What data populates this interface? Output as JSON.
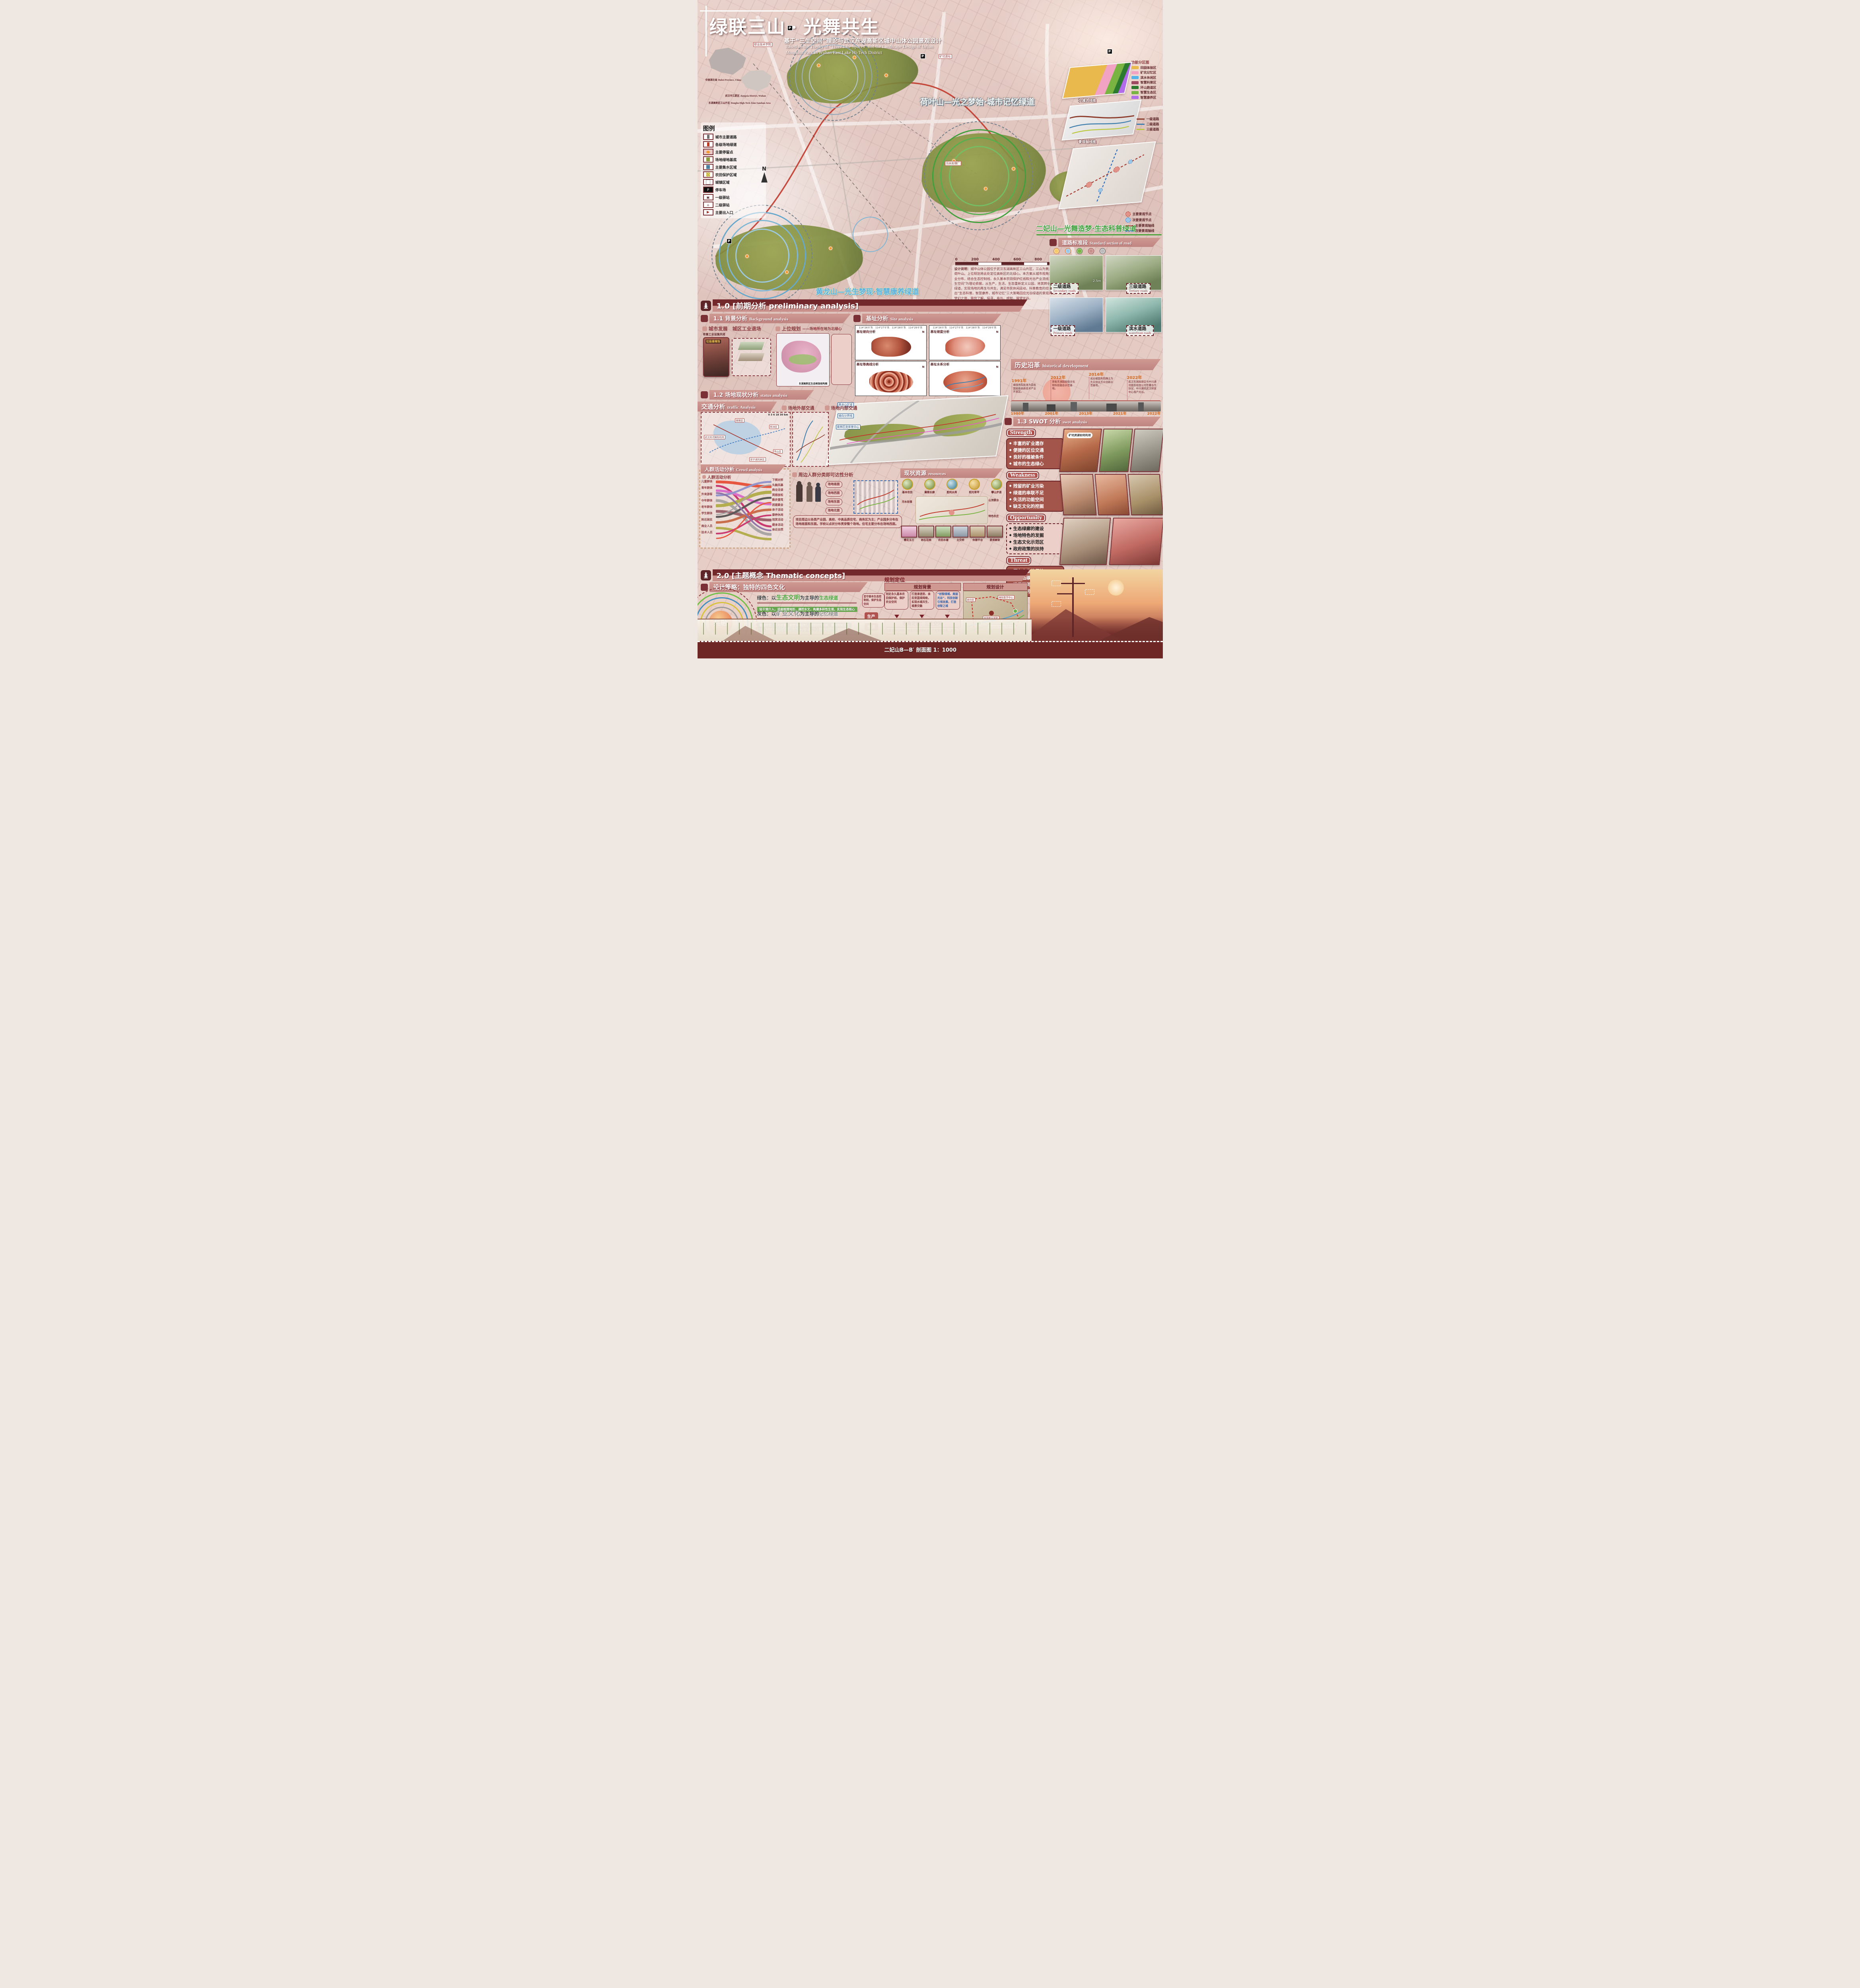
{
  "poster": {
    "title": "绿联三山 · 光舞共生",
    "subtitle_zh": "基于“三生空间”理论与武汉东湖高新区城中山体公园景观设计",
    "subtitle_en1": "Based on the Theory of \"Three Life Spaces\" and the Landscape Design of Urban",
    "subtitle_en2": "Mountain Park in Wuhan East Lake Hi-Tech District"
  },
  "location_maps": [
    {
      "zh": "中国湖北省",
      "en": "Hubei Province, China"
    },
    {
      "zh": "武汉市江夏区",
      "en": "Jiangxia District, Wuhan"
    },
    {
      "zh": "东湖高新区三山片区",
      "en": "Donghu High-Tech Zone Sanshan Area"
    }
  ],
  "legend": {
    "title": "图例",
    "items": [
      {
        "label": "城市主要道路"
      },
      {
        "label": "各级场地绿道"
      },
      {
        "label": "主要停留点"
      },
      {
        "label": "场地绿地基底"
      },
      {
        "label": "主要集水区域"
      },
      {
        "label": "农田保护区域"
      },
      {
        "label": "城镇区域"
      },
      {
        "label": "停车场"
      },
      {
        "label": "一级驿站"
      },
      {
        "label": "二级驿站"
      },
      {
        "label": "主要出入口"
      }
    ]
  },
  "main_map": {
    "north": "N",
    "scalebar": [
      "0",
      "200",
      "400",
      "600",
      "800",
      "1000 M"
    ],
    "banners": [
      {
        "text": "荷叶山—光之梦始·城市记忆绿道"
      },
      {
        "text": "二妃山—光舞造梦·生态科普绿道"
      },
      {
        "text": "黄龙山—光生梦现·智慧康养绿道"
      }
    ],
    "labels": [
      "职业技术学院",
      "矿坑遗址",
      "污水处理厂"
    ],
    "parking": "P"
  },
  "side_maps": {
    "functional": {
      "title": "功能分区图",
      "legend": [
        {
          "label": "田园体验区",
          "color": "#eab94d"
        },
        {
          "label": "矿坑记忆区",
          "color": "#f2a3c3"
        },
        {
          "label": "滨水休闲区",
          "color": "#54b4ea"
        },
        {
          "label": "智慧科普区",
          "color": "#9e4a62"
        },
        {
          "label": "环山跑道区",
          "color": "#2c7a2e"
        },
        {
          "label": "智慧生态区",
          "color": "#79b342"
        },
        {
          "label": "智慧康养区",
          "color": "#b26ce9"
        }
      ]
    },
    "traffic": {
      "title": "交通流线图",
      "legend": [
        {
          "label": "一级道路",
          "color": "#8c3a2a"
        },
        {
          "label": "二级道路",
          "color": "#3f7fae"
        },
        {
          "label": "三级道路",
          "color": "#bcc940"
        }
      ]
    },
    "axis": {
      "title": "景观轴线图",
      "legend": [
        {
          "label": "主要景观节点",
          "color": "#e2938a"
        },
        {
          "label": "次要景观节点",
          "color": "#9cc8e8"
        },
        {
          "label": "主要景观轴线",
          "color": "#a33226"
        },
        {
          "label": "次要景观轴线",
          "color": "#2f6fbf"
        }
      ]
    }
  },
  "design_note": {
    "label": "设计说明：",
    "text": "城中山体公园位于武汉东湖高新区三山片区，三山为黄龙山、二妃山和荷叶山。上位规划将此处定位高新区的北绿心。本方案从城市视角宏观分析片区产业分布，结合生态控制线，永久基本农田保护红线和光谷产业流线为依托，以“三生空间”为理论依据，从生产，生活，生态重新定义公园，将其转化为连接城市的绿道，实现场地的再生与共生，满足市民休闲运动，科普教育的综合性绿道。提出“生态科普，智慧康养，城市记忆”三大策略回应光谷绿道的景观问题，打造光谷梦幻之旅，带您了解，探寻，参与，感知，展望光谷。"
  },
  "road_section": {
    "title_zh": "道路标准段",
    "title_en": "Standard section of road",
    "dim": "2.5m",
    "roads": [
      {
        "zh": "二级道路",
        "en": "Secondary roads"
      },
      {
        "zh": "三级道路",
        "en": "Tertiary roads"
      },
      {
        "zh": "一级道路",
        "en": "Primary roads"
      },
      {
        "zh": "滨水道路",
        "en": "waterfront roads"
      }
    ]
  },
  "s10": {
    "label": "1.0 [前期分析 preliminary analysis]"
  },
  "s11": {
    "label_zh": "1.1 背景分析",
    "label_en": "Background analysis",
    "city_head": "城市发展　城区工业退场",
    "city_note": "有害工业设施关闭",
    "city_caption": "垃圾填埋场",
    "upper_head": "上位规划",
    "upper_dash": "——场地所在地为北绿心",
    "upper_caption": "东湖高新区生态框架结构图"
  },
  "s12": {
    "label_zh": "1.2 场地现状分析",
    "label_en": "status analysis"
  },
  "traffic_analysis": {
    "label_zh": "交通分析",
    "label_en": "traffic Analysis",
    "sub1": "场地外部交通",
    "sub2": "场地内部交通",
    "ext_labels": [
      "武汉天河国际机场",
      "黄陂区",
      "新洲区",
      "梁子湖风景区",
      "铁山区"
    ],
    "scalebar": "0 3 6 18 30 km"
  },
  "site_analysis": {
    "label_zh": "基址分析",
    "label_en": "Site analysis",
    "north": "N",
    "coords": "114°26′0″东　114°27′0″东　114°28′0″东　114°29′0″东",
    "panels": [
      "基址坡向分析",
      "基址坡度分析",
      "基址等高线分析",
      "基址水系分析"
    ],
    "axon_labels": [
      "黄龙山区域",
      "坡向分界线",
      "奥林匹克体育中心"
    ]
  },
  "history": {
    "label_zh": "历史沿革",
    "label_en": "historical development",
    "top": [
      {
        "year": "1991年",
        "text": "被国务院批准为首批国家级高新技术产业开发区。"
      },
      {
        "year": "2012年",
        "text": "获批东湖国家级文化和科技融合示范基地。"
      },
      {
        "year": "2016年",
        "text": "光谷被国务院确立为大众创业万众创新示范基地。"
      },
      {
        "year": "2022年",
        "text": "武汉东湖高新区与中兴通讯股份有限公司签署合作协议，中兴通讯武汉研发中心落户光谷。"
      }
    ],
    "bottom_years": [
      "1980年",
      "2001年",
      "2013年",
      "2021年",
      "2022年"
    ]
  },
  "swot": {
    "label_zh": "1.3 SWOT 分析",
    "label_en": "swot analysis",
    "bubble": "矿坑资源如何利用",
    "s": {
      "title": "Strength",
      "items": [
        "丰富的矿业遗存",
        "便捷的区位交通",
        "良好的植被条件",
        "城市的生态绿心"
      ]
    },
    "w": {
      "title": "Weakness",
      "items": [
        "残留的矿业污染",
        "绿道的串联不足",
        "失活的功能空间",
        "缺乏文化的挖掘"
      ]
    },
    "o": {
      "title": "Opportunity",
      "items": [
        "生态绿廊的建设",
        "场地特色的发掘",
        "生态文化示范区",
        "政府政策的扶持"
      ]
    },
    "t": {
      "title": "Threat",
      "items": [
        "原有产业的保护",
        "绿色低碳的要求",
        "满足不同的需求",
        "发展的可持续性"
      ]
    }
  },
  "crowd": {
    "label_zh": "人群活动分析",
    "label_en": "Crowd analysis",
    "sub": "人群活动分析",
    "groups": [
      "儿童群体",
      "青年群体",
      "外来游客",
      "中年群体",
      "老年群体",
      "学生群体",
      "附近居民",
      "商业人员",
      "技术人员"
    ],
    "activities": [
      "下棋对弈",
      "头脑风暴",
      "商业洽谈",
      "冥想放松",
      "散步遛弯",
      "团建聚会",
      "亲子活动",
      "康养休闲",
      "观赏活动",
      "健身活动",
      "亲近自然"
    ]
  },
  "periphery": {
    "head": "周边人群分类即可达性分析",
    "note": "项目周边以各类产业园、高校、中高品质住宅、商务区为主；产业园多分布在场地南面和东面。学校以点状分布贯穿整个场地。住宅主要分布在场地西面。",
    "directions": [
      "场地南面",
      "场地西面",
      "场地东面",
      "场地北面"
    ]
  },
  "resources": {
    "label_zh": "现状资源",
    "label_en": "resources",
    "nodes": [
      "基本农田",
      "蒹葭长廊",
      "胜利水库",
      "阳光草坪",
      "攀山步道",
      "污水处理",
      "山顶景台",
      "特色农庄"
    ],
    "photos": [
      "樱花玉兰",
      "岩石花园",
      "农田水塘",
      "立交桥",
      "休憩平台",
      "景观廊架"
    ]
  },
  "s20": {
    "label": "2.0 [主题概念  Thematic concepts]"
  },
  "strategy": {
    "head": "设计策略：独特的四色文化",
    "center": "共融",
    "lines": [
      {
        "prefix": "绿色：以",
        "key": "生态文明",
        "mid": "为主导的",
        "tail": "生态绿道",
        "color": "#4ea43c",
        "sub": "轻干预介入，适度梳理地形，调控水文，构建多样性生境，实现生态核心",
        "sub_bg": "#69a84e"
      },
      {
        "prefix": "灰色：以",
        "key": "矿业文化",
        "mid": "为主导的",
        "tail": "记忆绿道",
        "color": "#8d8d8d",
        "sub": "能源转型，生态修复，重塑场地记忆，感受时代发展，重唤场地活力",
        "sub_bg": "#7c7c7c"
      },
      {
        "prefix": "蓝色：以",
        "key": "光谷科技",
        "mid": "为主导的",
        "tail": "活力绿道",
        "color": "#5ba8d8",
        "sub": "公园维护智能化，“智慧性”体验，互动性增加，新能源持续生态效益",
        "sub_bg": "#5b9fd0"
      },
      {
        "prefix": "黄色：以",
        "key": "农耕文化",
        "mid": "为主导的",
        "tail": "田园绿道",
        "color": "#c8a62c",
        "sub": "",
        "sub_bg": "#c8a62c"
      }
    ],
    "sanshen": [
      "生产",
      "生活",
      "生态"
    ],
    "eco_note": "坚守基本生态控制线，保护生态空间"
  },
  "planning": {
    "head_left": "规划定位",
    "bg_head": "规划背景",
    "design_head": "规划设计",
    "vp": "视角定位：三生空间",
    "boxes": [
      "划定永久基本农田保护线，保护农业空间",
      "打造渗透型、亲民型蓝绿网络，实现水城共生、城景交融",
      "“创智绿城、美丽光谷”，科技创新引领发展，打造创智之城"
    ],
    "flows": [
      "连接城市与绿楔，完善交通流线系统，打造漫游之地，实现场地的再生与共生",
      "在空间上打造以绿道为主要脉络的全季全时全年龄段的多主题旅游场地，建设最具影响力的“魅力光谷”。"
    ],
    "map_labels": [
      "居住区",
      "国际医学中心",
      "体育职业学院",
      "华中科技大学同济医学院",
      "湖北第二师范学院"
    ]
  },
  "section_view": {
    "label": "二妃山B—B′ 剖面图 1：1000"
  }
}
